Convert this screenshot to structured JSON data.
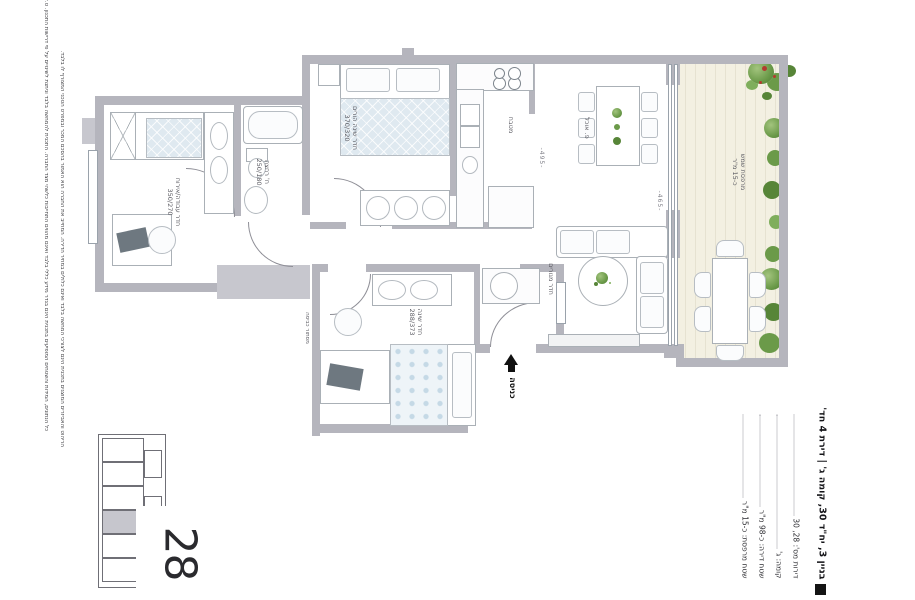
{
  "colors": {
    "wall": "#b5b5bd",
    "deck": "#f3f0e2",
    "plant_green": "#6b9a49",
    "blanket_blue": "#dfe9f0",
    "text_dark": "#141418"
  },
  "disclaimer": {
    "line1": "כל הנתונים, המידות והשטחים המופיעים בתכנית הינם בגדר מידע כללי בלבד ואינם מהווים התחייבות כלשהי מצד החברה. התכנית להמחשה בלבד וניתנת לשינויים על פי דרישות התכנון. ט.ל.ח.",
    "line2": "הריהוט והאביזרים המוצגים בתכנית הינם לצורכי המחשה בלבד ואינם כלולים במחיר הדירה. המחייב את החברה הוא האמור בהסכם המכר ובמפרט הטכני המצורף לו בלבד."
  },
  "plan": {
    "rooms": {
      "study": {
        "label": "חדר עבודה/אירוח",
        "dims": "350/270"
      },
      "bath": {
        "label": "ח' רחצה",
        "dims": "250/180"
      },
      "master": {
        "label": "חדר שינה הורים",
        "dims": "370/320"
      },
      "kitchen": {
        "label": "מטבח"
      },
      "dining": {
        "label": "פ. אוכל"
      },
      "living": {
        "label": "חדר מגורים"
      },
      "terrace": {
        "label": "מרפסת שמש",
        "dims": "כ-15 מ\"ר"
      },
      "bedroom2": {
        "label": "חדר שינה",
        "dims": "288/373"
      },
      "laundry": {
        "label": "מסתור כביסה"
      },
      "entrance": {
        "label": "כניסה"
      }
    },
    "dims": {
      "living_width": "-495-",
      "living_length": "-465-"
    }
  },
  "keyplan": {
    "unit": "28"
  },
  "info": {
    "title": "בניין 3, יח\"ד 30, קומה ג' | דירת 4 חד'",
    "specs": [
      "דירות מס': 28, 30",
      "קומה: ג'",
      "שטח דירה: כ-98 מ\"ר",
      "שטח מרפסת: כ-15 מ\"ר"
    ]
  }
}
